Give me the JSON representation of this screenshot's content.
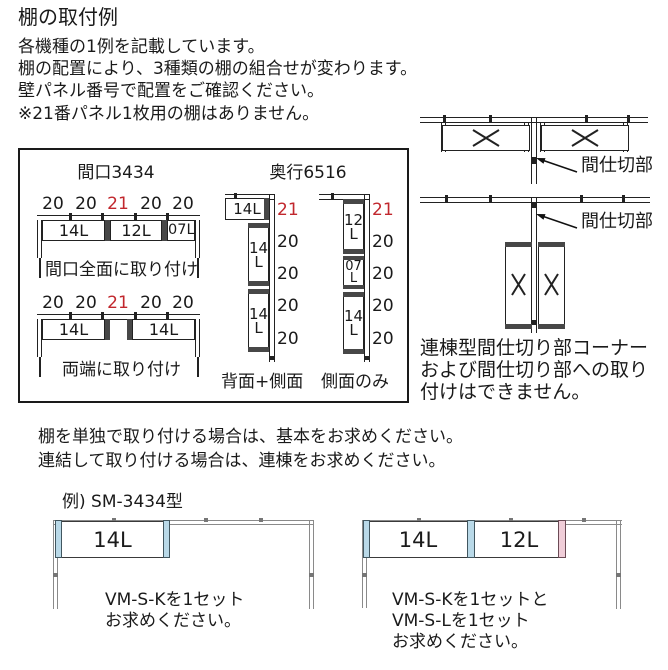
{
  "title": "棚の取付例",
  "intro": {
    "line1": "各機種の1例を記載しています。",
    "line2": "棚の配置により、3種類の棚の組合せが変わります。",
    "line3": "壁パネル番号で配置をご確認ください。",
    "line4": "※21番パネル1枚用の棚はありません。"
  },
  "colors": {
    "red_accent": "#c1272d",
    "blue_bracket": "#b9d9e8",
    "pink_bracket": "#f0cdd8"
  },
  "overview_box": {
    "width_section": {
      "header": "間口3434",
      "full_width": {
        "panel_numbers": [
          "20",
          "20",
          "21",
          "20",
          "20"
        ],
        "shelf1": "14L",
        "shelf2": "12L",
        "shelf3": "07L",
        "caption": "間口全面に取り付け"
      },
      "both_ends": {
        "panel_numbers": [
          "20",
          "20",
          "21",
          "20",
          "20"
        ],
        "shelf1": "14L",
        "shelf2": "14L",
        "caption": "両端に取り付け"
      }
    },
    "depth_section": {
      "header": "奥行6516",
      "back_side": {
        "top_shelf": "14L",
        "panel_numbers": [
          "21",
          "20",
          "20",
          "20",
          "20"
        ],
        "shelf1": {
          "num": "14",
          "suffix": "L"
        },
        "shelf2": {
          "num": "14",
          "suffix": "L"
        },
        "caption": "背面+側面"
      },
      "side_only": {
        "panel_numbers": [
          "21",
          "20",
          "20",
          "20",
          "20"
        ],
        "shelf1": {
          "num": "12",
          "suffix": "L"
        },
        "shelf2": {
          "num": "07",
          "suffix": "L"
        },
        "shelf3": {
          "num": "14",
          "suffix": "L"
        },
        "caption": "側面のみ"
      }
    }
  },
  "partition_diagrams": {
    "top_label": "間仕切部",
    "bottom_label": "間仕切部",
    "note": {
      "line1": "連棟型間仕切り部コーナー",
      "line2": "および間仕切り部への取り",
      "line3": "付けはできません。"
    }
  },
  "purchase_note": {
    "line1": "棚を単独で取り付ける場合は、基本をお求めください。",
    "line2": "連結して取り付ける場合は、連棟をお求めください。"
  },
  "example": {
    "heading": "例) SM-3434型",
    "left_diagram": {
      "shelf1": "14L",
      "note_line1": "VM-S-Kを1セット",
      "note_line2": "お求めください。"
    },
    "right_diagram": {
      "shelf1": "14L",
      "shelf2": "12L",
      "note_line1": "VM-S-Kを1セットと",
      "note_line2": "VM-S-Lを1セット",
      "note_line3": "お求めください。"
    }
  }
}
